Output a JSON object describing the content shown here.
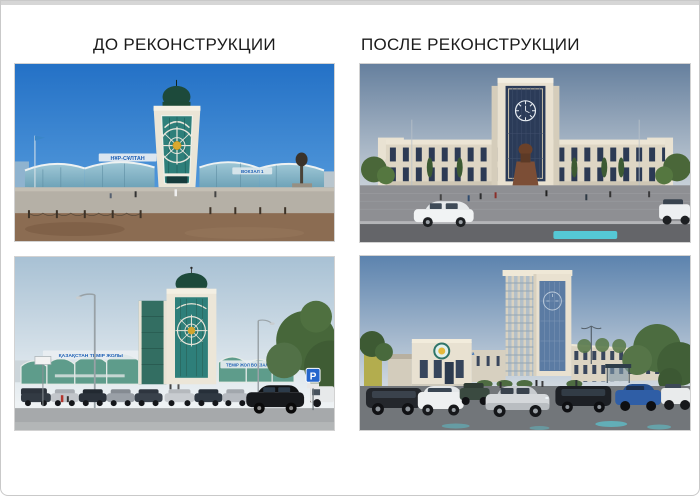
{
  "headers": {
    "before": "ДО РЕКОНСТРУКЦИИ",
    "after": "ПОСЛЕ РЕКОНСТРУКЦИИ"
  },
  "photo_signs": {
    "before_front_left": "НҰР-СҰЛТАН",
    "before_front_right": "ВОКЗАЛ 1",
    "before_side_left": "ҚАЗАҚСТАН ТЕМІР ЖОЛЫ",
    "before_side_right": "ТЕМІР ЖОЛ ВОКЗАЛЫ",
    "after_side_facade": "Астана",
    "parking_sign": "P"
  },
  "colors": {
    "header_text": "#1b1b1b",
    "page_border": "#c9c9c9",
    "sign_blue": "#1d5fb5",
    "glass_teal": "#2e7f7a",
    "glass_dark_blue": "#2b3b58",
    "building_cream": "#e9e1d0",
    "dome_green": "#1d4a3b",
    "pool_cyan": "#54cedb",
    "sky_before_front": "#2471c6"
  }
}
